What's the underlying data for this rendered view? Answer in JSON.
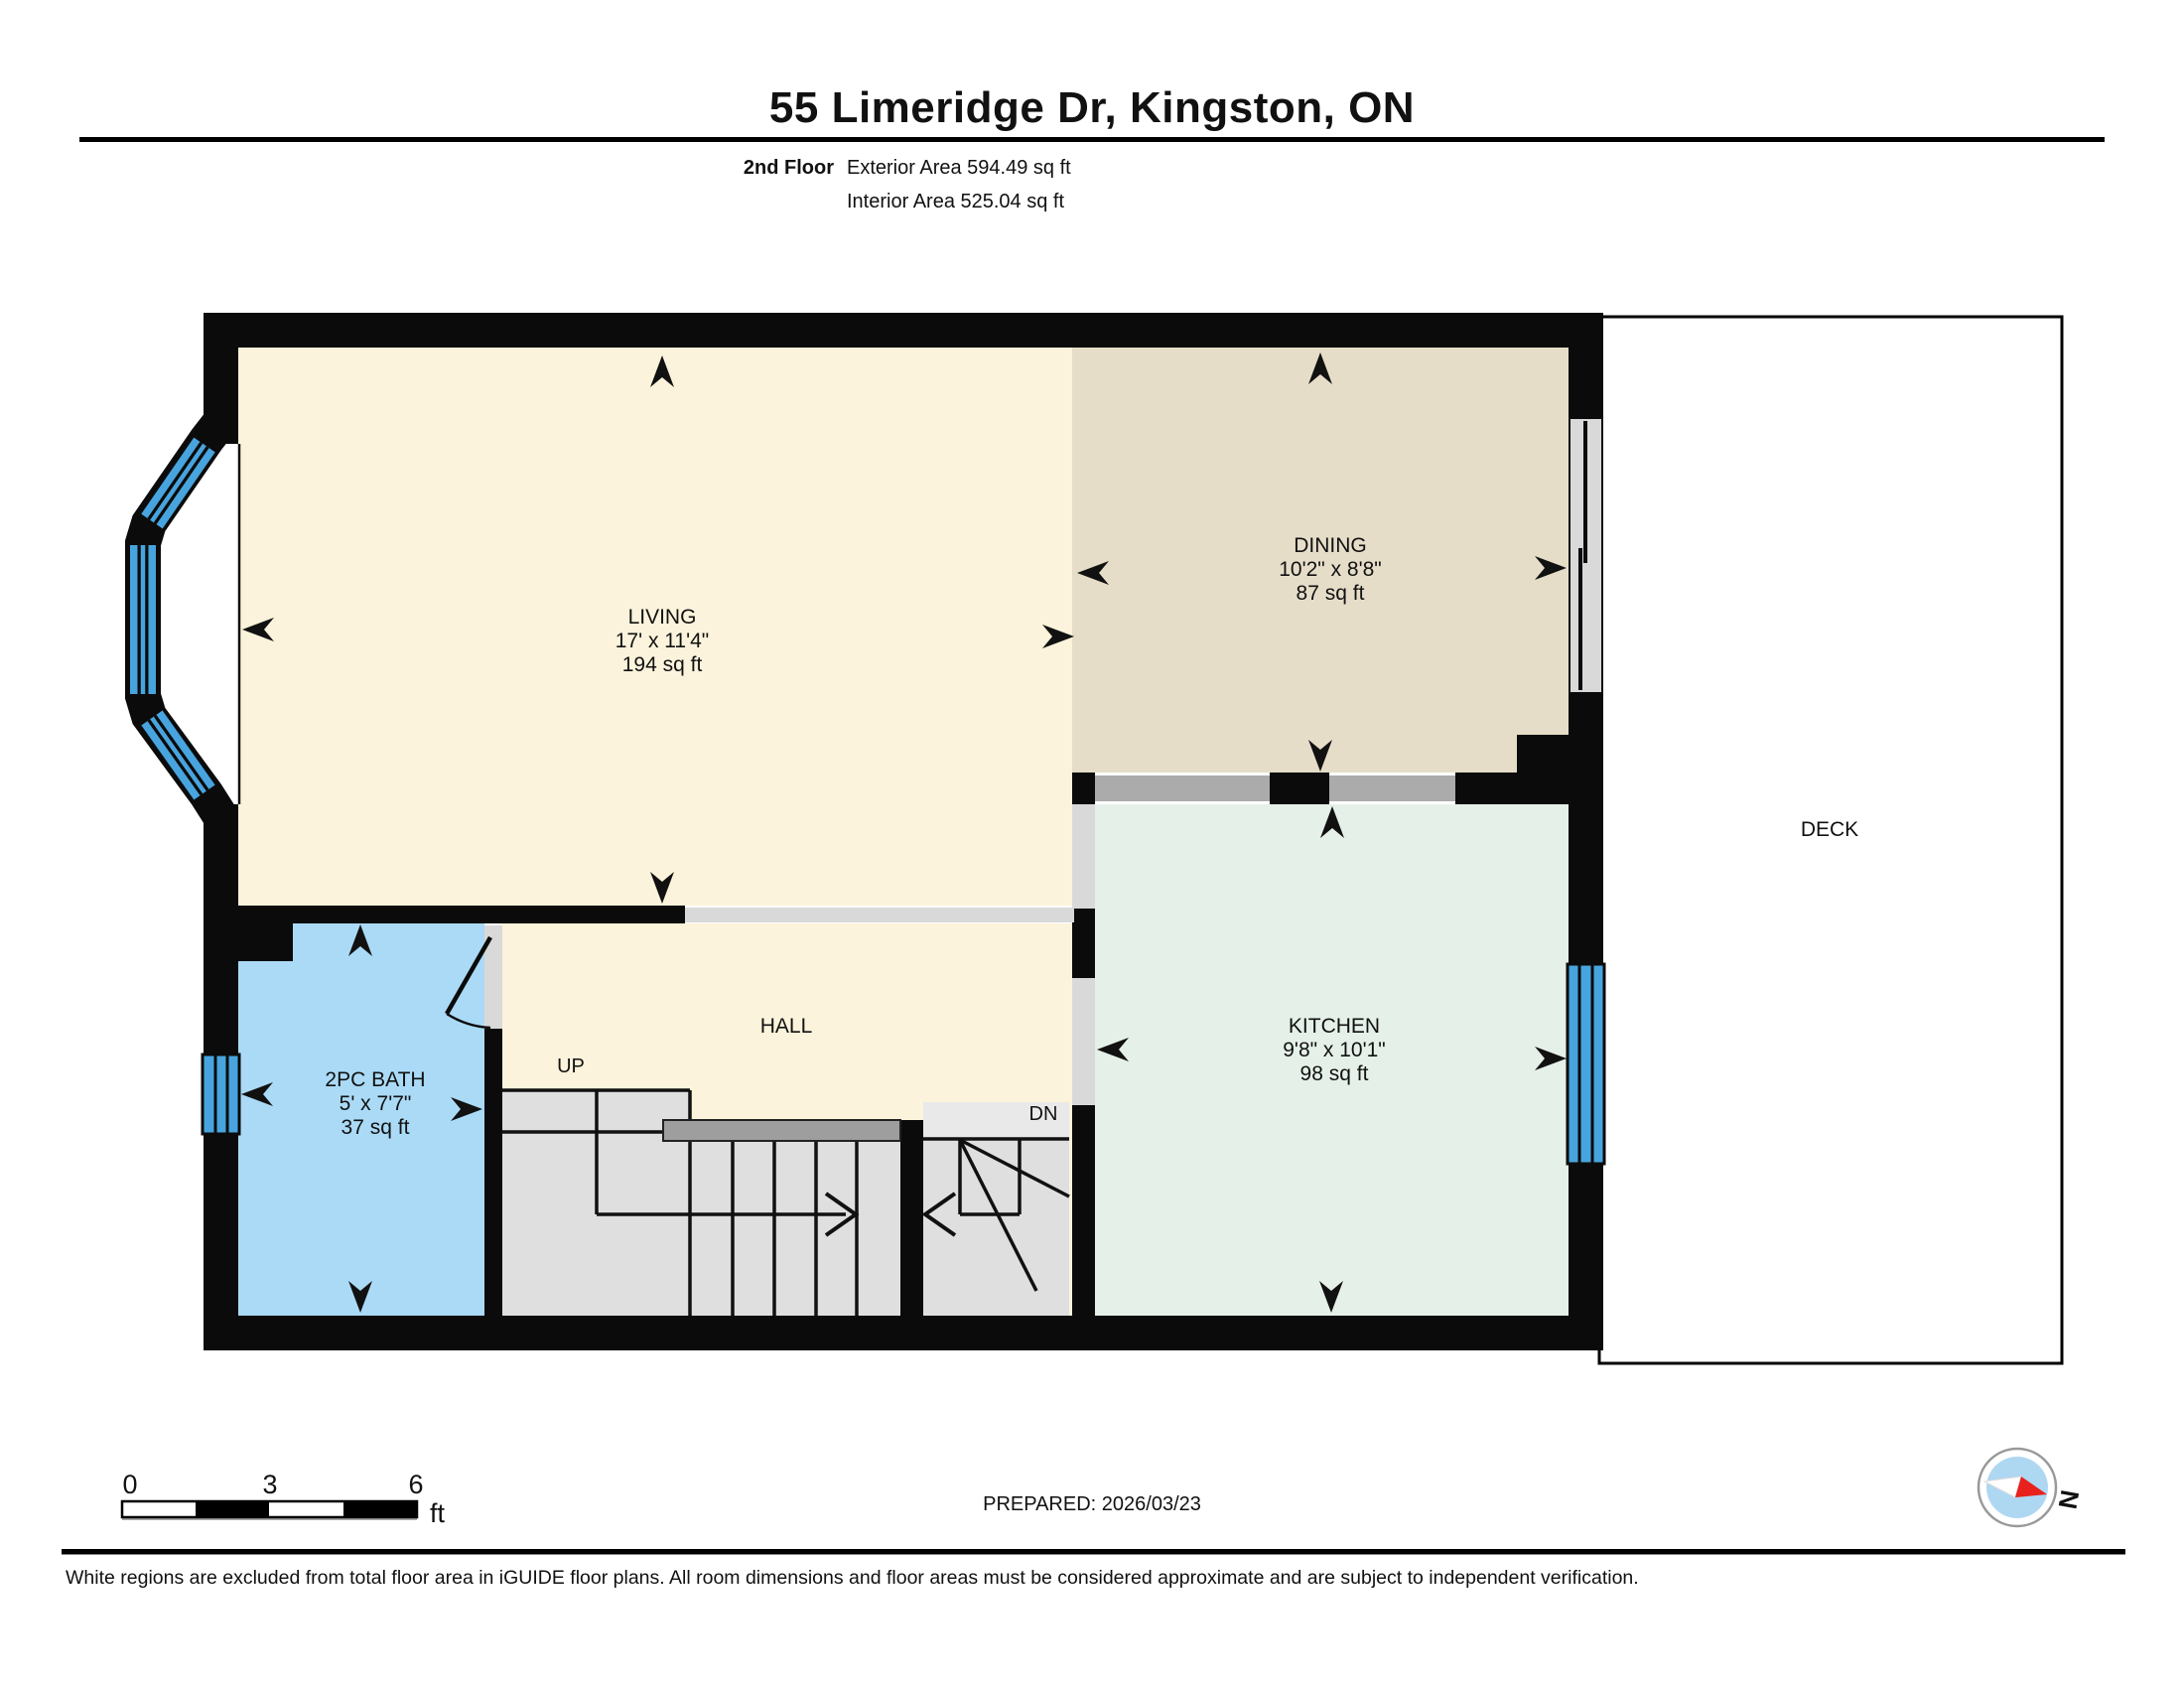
{
  "header": {
    "title": "55 Limeridge Dr, Kingston, ON",
    "floor_label": "2nd Floor",
    "exterior_area": "Exterior Area 594.49 sq ft",
    "interior_area": "Interior Area 525.04 sq ft"
  },
  "rooms": {
    "living": {
      "name": "LIVING",
      "dims": "17' x 11'4\"",
      "area": "194 sq ft"
    },
    "dining": {
      "name": "DINING",
      "dims": "10'2\" x 8'8\"",
      "area": "87 sq ft"
    },
    "kitchen": {
      "name": "KITCHEN",
      "dims": "9'8\" x 10'1\"",
      "area": "98 sq ft"
    },
    "bath": {
      "name": "2PC BATH",
      "dims": "5' x 7'7\"",
      "area": "37 sq ft"
    },
    "hall": {
      "name": "HALL"
    },
    "deck": {
      "name": "DECK"
    }
  },
  "stairs": {
    "up": "UP",
    "down": "DN"
  },
  "scale_bar": {
    "ticks": [
      "0",
      "3",
      "6"
    ],
    "unit": "ft"
  },
  "footer": {
    "prepared": "PREPARED: 2026/03/23",
    "north_label": "N",
    "disclaimer": "White regions are excluded from total floor area in iGUIDE floor plans. All room dimensions and floor areas must be considered approximate and are subject to independent verification."
  },
  "colors": {
    "wall": "#0b0b0b",
    "living": "#fbf3db",
    "dining": "#e6ddc9",
    "kitchen": "#e5f0e8",
    "bath": "#aadaf6",
    "hall": "#fbf3db",
    "stairs": "#dfdfdf",
    "opening": "#d9d9d9",
    "counter": "#ababab",
    "window": "#47a4de",
    "deck": "#ffffff",
    "compass_inner": "#aed7f2",
    "compass_needle": "#e8211d"
  }
}
